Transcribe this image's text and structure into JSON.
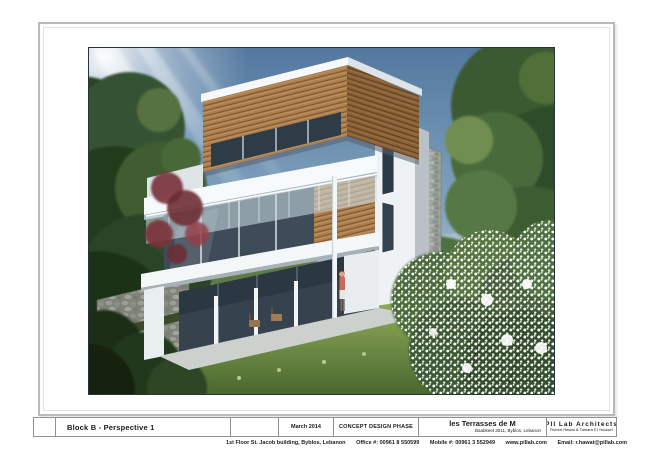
{
  "sheet": {
    "drawing_title": "Block B - Perspective 1",
    "date": "March 2014",
    "phase": "CONCEPT DESIGN PHASE",
    "project": {
      "name": "les Terrasses de M",
      "location": "Baabkeet 3011, Byblos, Lebanon"
    },
    "architect": {
      "name": "PII Lab Architects",
      "principals": "Robert Hawat & Tamara El Youssef"
    },
    "contact": {
      "address": "1st Floor St. Jacob building, Byblos, Lebanon",
      "office": "Office #: 00961 8 550599",
      "mobile": "Mobile #: 00961 3 552949",
      "website": "www.pillab.com",
      "email": "Email: r.hawat@pillab.com"
    }
  },
  "render": {
    "alt": "Perspective rendering of Block B: modern three-storey villa with cantilevered wood-clad top volume, white concrete slabs, glass balustrade balconies, stone wall, columns, surrounded by trees, lawn, stone retaining walls and a white flowering bush, under a blue sky with sun rays"
  },
  "colors": {
    "sky_top": "#54789f",
    "sky_horizon": "#ccdbe1",
    "wood": "#ad7f4e",
    "foliage_dark": "#2c4526",
    "foliage_light": "#6f8e50",
    "lawn": "#93ad5a",
    "slab_white": "#f7fafb",
    "frame_border": "#b7babd"
  }
}
